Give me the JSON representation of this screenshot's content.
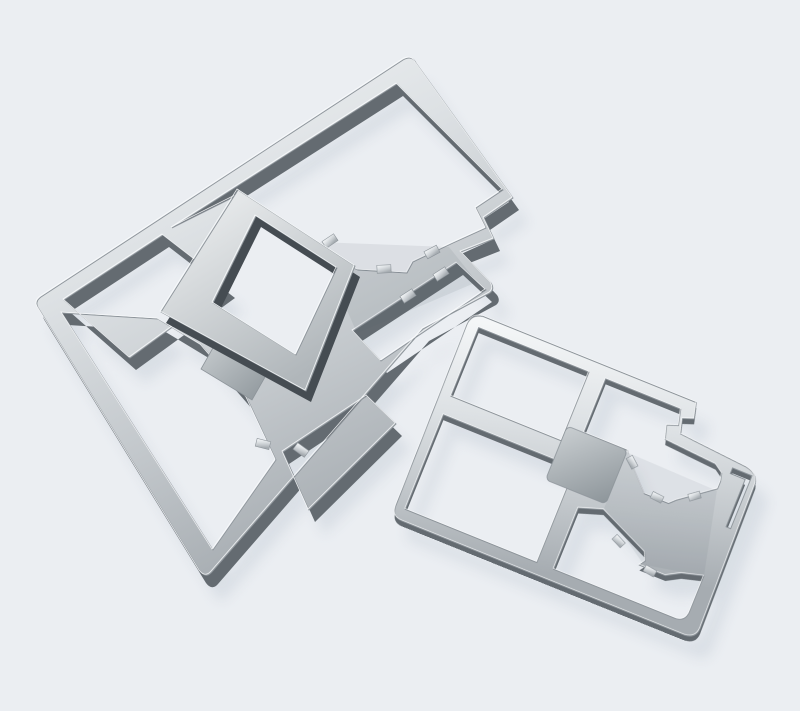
{
  "meta": {
    "description": "Product photograph of two stamped sheet-metal EMI shielding frames lying on a plain pale blue-grey backdrop. The upper-left frame is tilted about 33 degrees and shows its formed side walls, a raised inner square fence, a solid brushed center pad and a pentagon-shaped notched cut-out with small solder tabs. The lower-right frame lies flatter, divided into four window openings by cross ribs with a solid center pad, a stepped corner notch, a thin edge slit and solder tabs."
  },
  "colors": {
    "background": "#ebeef2",
    "shadow": "#c3ccd6",
    "metal_hi": "#f6f8f9",
    "metal_light": "#dde1e4",
    "metal_mid": "#c2c7cb",
    "metal_low": "#a6acb1",
    "pad_hi": "#c9ced1",
    "pad_lo": "#8d959a",
    "square_hi": "#f2f4f5",
    "square_lo": "#b0b6ba",
    "wall": "#646b71",
    "wall_edge": "#454c52",
    "edge_stroke": "#8d949a",
    "highlight_stroke": "#fafcfd",
    "band_shade": "#59616a",
    "tab_fill": "#cfd4d7"
  },
  "scene": {
    "object_count": 2,
    "surface": "plain light grey-blue backdrop",
    "material": "brushed silver sheet metal",
    "objects": [
      {
        "id": "left-shield-frame",
        "label": "Stamped shielding frame, tilted with side walls visible",
        "position": "upper left",
        "features": "window openings, raised inner square fence, solid center pad, pentagon notch with solder tabs, stepped edge notch"
      },
      {
        "id": "right-shield-frame",
        "label": "Stamped shielding frame, lying nearly flat",
        "position": "lower right",
        "features": "four window openings, solid center pad, pentagon notch with solder tabs, corner step notch, thin edge slit"
      }
    ]
  }
}
